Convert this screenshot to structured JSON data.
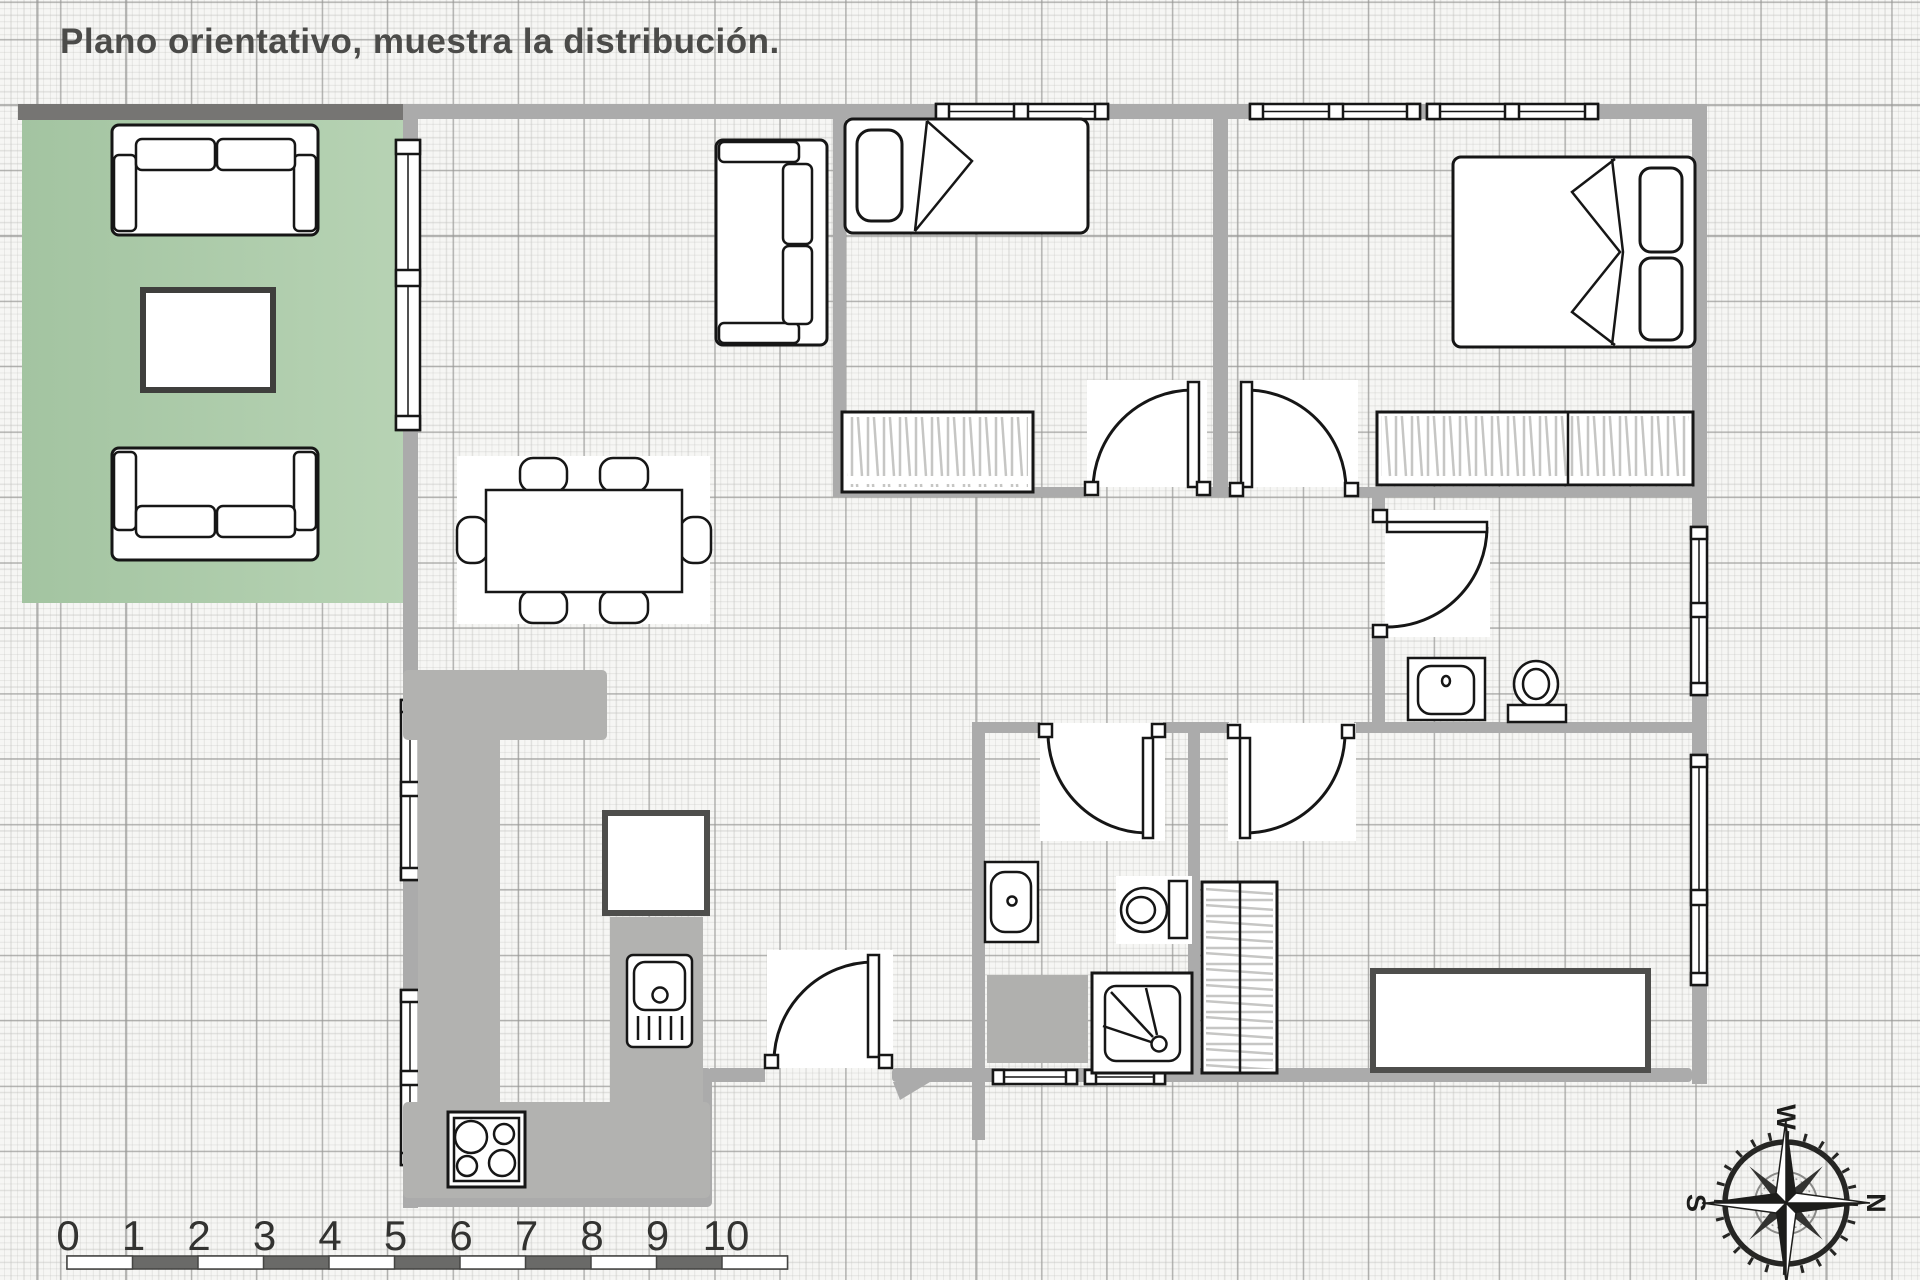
{
  "title": "Plano orientativo, muestra la distribución.",
  "scale_ruler": {
    "unit_labels": [
      "0",
      "1",
      "2",
      "3",
      "4",
      "5",
      "6",
      "7",
      "8",
      "9",
      "10"
    ]
  },
  "compass": {
    "north": "N",
    "south": "S",
    "east": "E",
    "west": "W"
  },
  "colors": {
    "grid_paper": "#f6f6f4",
    "wall_gray": "#ababab",
    "terrace_wall": "#767573",
    "terrace_green_dark": "#a3c4a1",
    "terrace_green_light": "#b7d3b4",
    "counter_gray": "#b2b2b0",
    "outline_black": "#161616",
    "furniture_dark_border": "#4e4e4c",
    "hatch_gray": "#c6c6c4",
    "title_color": "#4b4b49",
    "ruler_dark": "#6a6a68"
  }
}
